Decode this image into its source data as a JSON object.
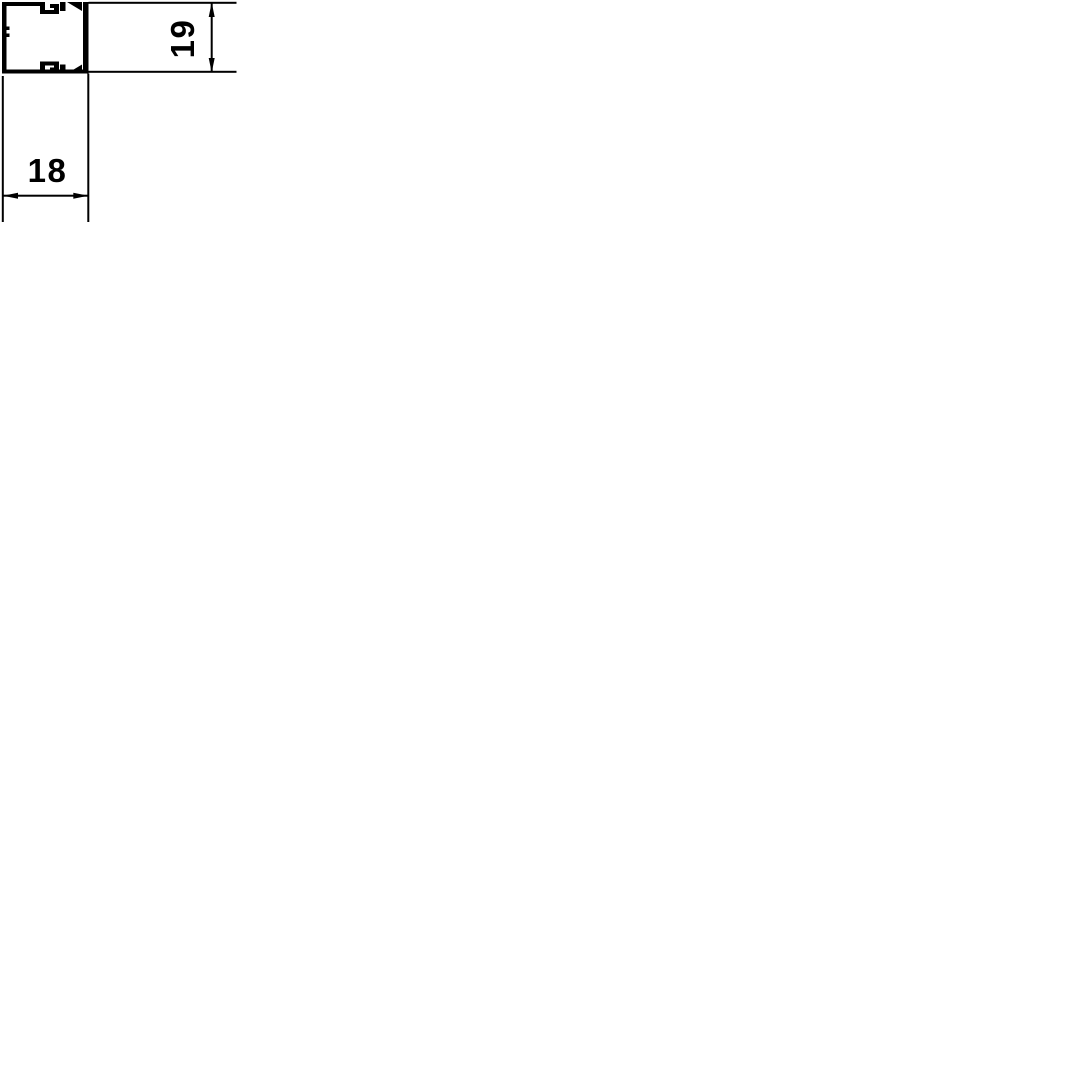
{
  "page": {
    "background_color": "#ffffff"
  },
  "diagram": {
    "type": "technical-cross-section-drawing",
    "subject": "cable trunking profile with cover, sectional view",
    "ink_color": "#000000",
    "dimensions": {
      "width": {
        "label": "18"
      },
      "height": {
        "label": "19"
      }
    }
  }
}
